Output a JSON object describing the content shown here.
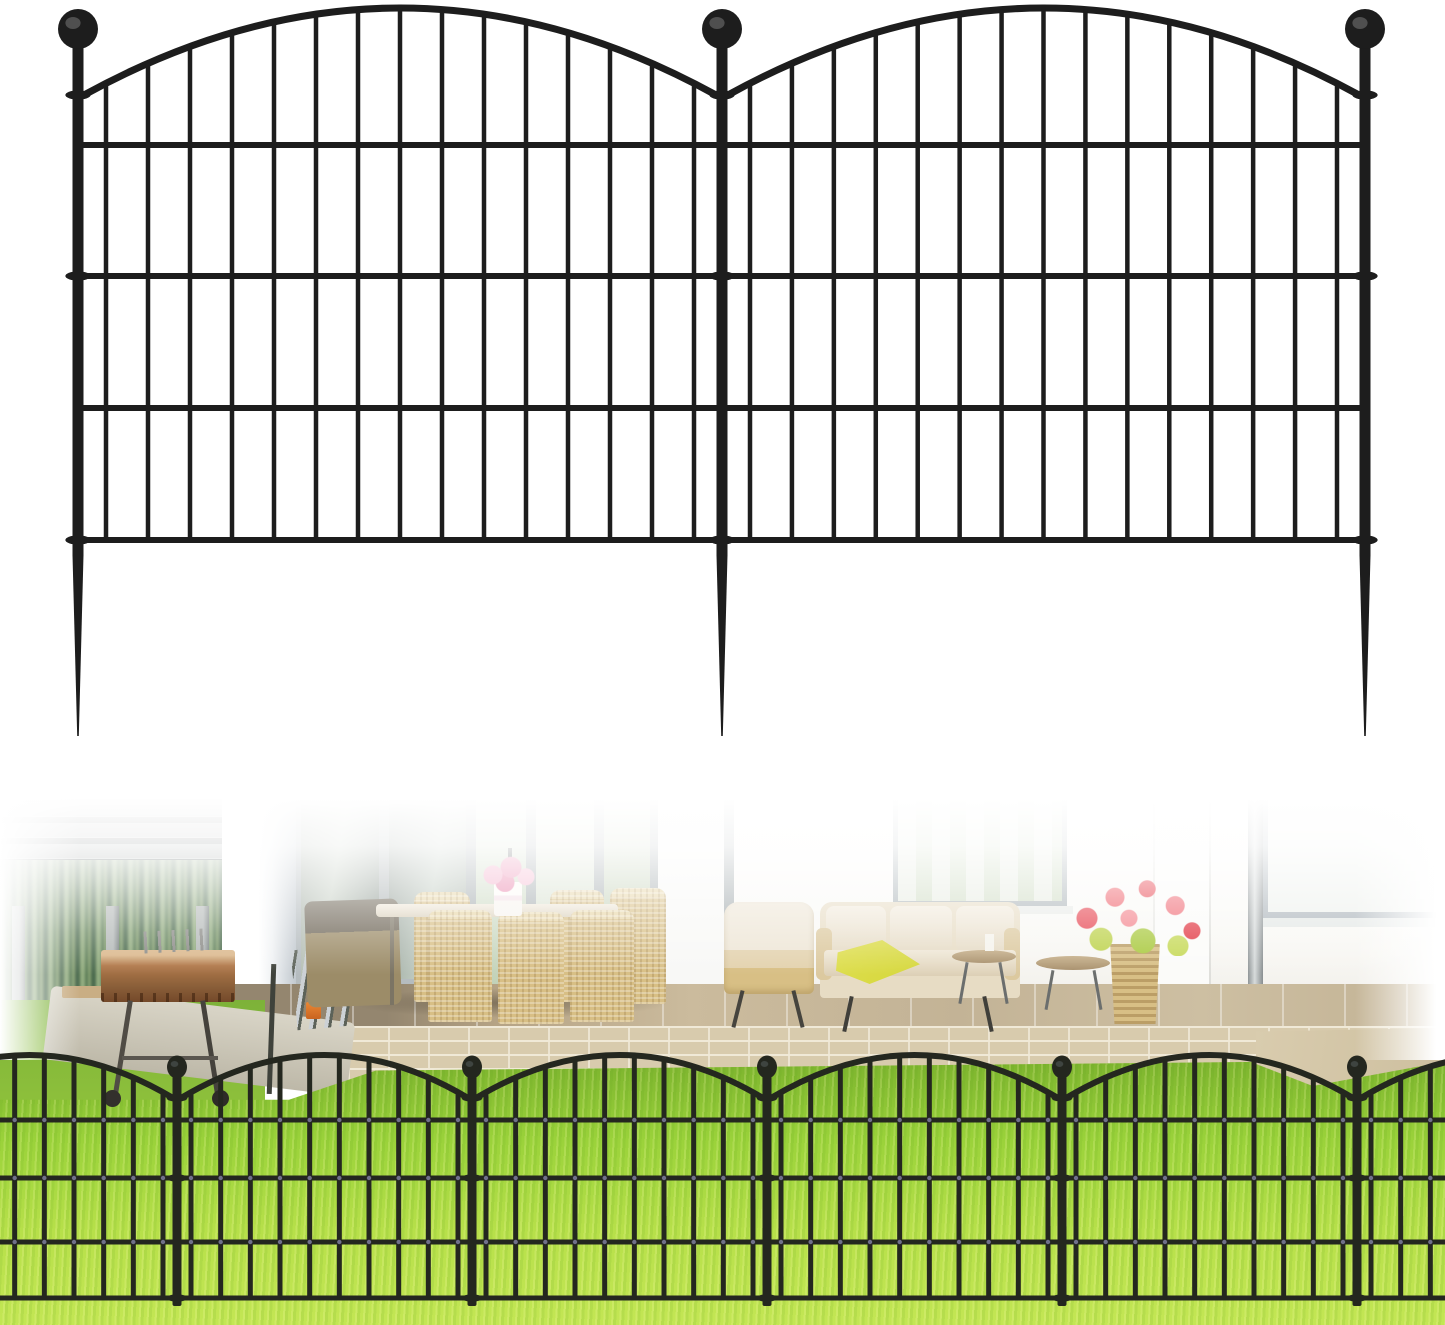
{
  "image": {
    "alt": "Product image of black metal decorative garden border fencing: top shows two connected arched wire fence panels with ball-finial posts and ground spike stakes on a white background; bottom shows the fence installed along a bright green lawn in front of a backyard patio with wicker furniture, a charcoal grill, red and pink flowers, gray wood fence, hedge and white house wall."
  },
  "colors": {
    "fence_black": "#1d1d1d",
    "fence_highlight": "#4f4f4f",
    "front_fence_black": "#24271f",
    "front_fence_highlight": "#3e4440",
    "weld_blue": "#70708a",
    "grass_bright": "#b7e04a",
    "grass_mid": "#9ad23a",
    "grass_dark": "#7cb32e",
    "brick_tan": "#d8cbad",
    "brick_mortar": "#f0e9d7",
    "patio_tan": "#c3b396",
    "patio_shadow": "#94866f",
    "hedge_green_dark": "#4c6b4e",
    "hedge_green_light": "#93ad80",
    "wood_gray": "#a7abab",
    "wood_gap": "#565d5e",
    "wicker_tan": "#d8bf85",
    "cushion_cream": "#eee6d6",
    "throw_yellow": "#d5d73b",
    "flower_pink": "#f2a9c6",
    "flower_red": "#e6414d",
    "foliage_yellow_green": "#bdd24b",
    "window_frame_gray": "#a9b2b6",
    "glass_green": "#cfdcc4",
    "downspout_gray": "#b6bcbc",
    "concrete_path": "#d9d5c7",
    "column_shadow": "#c2c9cf",
    "rust_orange": "#b0784a"
  },
  "top_fence": {
    "view_w": 1445,
    "view_h": 762,
    "posts": [
      78,
      722,
      1365
    ],
    "post_width": 11,
    "post_top": 46,
    "post_bottom": 557,
    "ball_cy": 29,
    "ball_r": 20,
    "ball_ry_ratio": 1,
    "clamp_ys": [
      95,
      276,
      540
    ],
    "rail_ys": [
      145,
      276,
      408,
      540
    ],
    "rail_w": 6,
    "arch": {
      "end_y": 95,
      "ctrl_y": -79,
      "w": 7,
      "inset": 6
    },
    "bars": {
      "count": 15,
      "width": 4.5,
      "bottom": 540,
      "inset": 28
    },
    "spike": {
      "top": 555,
      "tip": 736,
      "half_w": 5.5
    },
    "rails_full_width": false,
    "edge_overhang": false,
    "color_key": "fence_black",
    "ball_hi_key": "fence_highlight"
  },
  "front_fence": {
    "view_w": 1445,
    "view_h": 565,
    "posts": [
      177,
      472,
      767,
      1062,
      1357
    ],
    "post_width": 9,
    "post_top": 316,
    "post_bottom": 546,
    "ball_cy": 307,
    "ball_r": 10,
    "ball_ry_ratio": 1.15,
    "clamp_ys": [
      338,
      418,
      538
    ],
    "rail_ys": [
      360,
      418,
      482,
      538
    ],
    "rail_w": 5,
    "arch": {
      "end_y": 338,
      "ctrl_y": 252,
      "w": 6,
      "inset": 4
    },
    "bars": {
      "count": 10,
      "width": 5,
      "bottom": 538,
      "inset": 14
    },
    "spike": null,
    "rails_full_width": true,
    "edge_overhang": true,
    "weld_dot_rails": [
      0,
      1,
      2
    ],
    "weld_color_key": "weld_blue",
    "color_key": "front_fence_black",
    "ball_hi_key": "front_fence_highlight"
  },
  "scene": {
    "setting": "backyard patio with bright green lawn",
    "top_section": "white-background render of 2 arched fence panels, 3 posts with ball finials and spike stakes, 4 horizontal rails, 15 vertical bars per panel",
    "bottom_section": "photo of 5-post fence run installed at lawn edge",
    "background_items": [
      "cypress hedge",
      "gray wood slat fence",
      "white porch column",
      "rusty charcoal grill",
      "wicker dining set with pink bouquet",
      "sliding glass doors",
      "outdoor sofa with yellow throw",
      "wicker armchair",
      "round side tables with candle",
      "wicker planter with red geraniums",
      "downspout",
      "windows",
      "brick patio step",
      "concrete path",
      "lawn"
    ]
  }
}
